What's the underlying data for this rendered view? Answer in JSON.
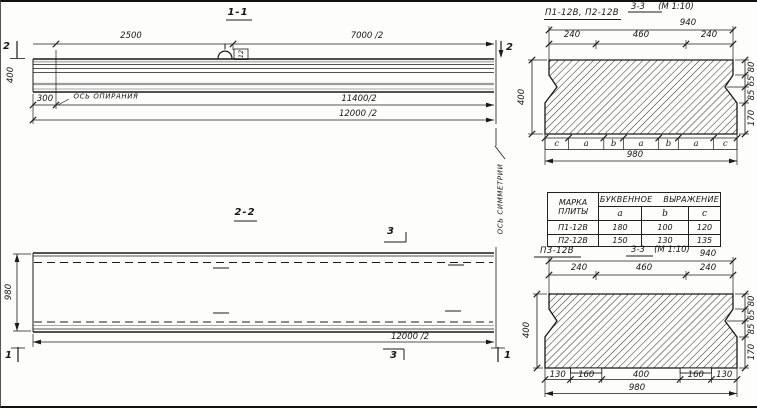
{
  "colors": {
    "ink": "#1a1a1a",
    "shade": "#a8a8a8",
    "paper": "#fdfdfb"
  },
  "section_1_1": {
    "title": "1-1",
    "dim_2500": "2500",
    "dim_7000": "7000 /2",
    "dim_11400": "11400/2",
    "dim_12000": "12000 /2",
    "dim_300": "300",
    "dim_height": "400",
    "support_axis_label": "ОСЬ ОПИРАНИЯ",
    "loop_mark": "12",
    "cut_marker_left": "2",
    "cut_marker_right": "2"
  },
  "section_2_2": {
    "title": "2-2",
    "dim_width": "980",
    "dim_12000": "12000 /2",
    "cut_marker_1_left": "1",
    "cut_marker_1_right": "1",
    "cut_marker_3_top": "3",
    "cut_marker_3_bottom": "3"
  },
  "symmetry_axis_label": "ОСЬ СИММЕТРИИ",
  "section_top": {
    "plate_label": "П1-12В, П2-12В",
    "title": "3-3",
    "scale": "(М 1:10)",
    "dim_total_top": "940",
    "dims_top": [
      "240",
      "460",
      "240"
    ],
    "dim_left": "400",
    "dims_right": [
      "80",
      "65",
      "85",
      "170"
    ],
    "letter_dims": [
      "c",
      "a",
      "b",
      "a",
      "b",
      "a",
      "c"
    ],
    "dim_total_bottom": "980"
  },
  "table": {
    "header_col1": [
      "МАРКА",
      "ПЛИТЫ"
    ],
    "header_span": "БУКВЕННОЕ ВЫРАЖЕНИЕ",
    "letter_columns": [
      "a",
      "b",
      "c"
    ],
    "rows": [
      {
        "mark": "П1-12В",
        "a": "180",
        "b": "100",
        "c": "120"
      },
      {
        "mark": "П2-12В",
        "a": "150",
        "b": "130",
        "c": "135"
      }
    ]
  },
  "section_bottom": {
    "plate_label": "П3-12В",
    "title": "3-3",
    "scale": "(М 1:10)",
    "dim_total_top": "940",
    "dims_top": [
      "240",
      "460",
      "240"
    ],
    "dim_left": "400",
    "dims_right": [
      "80",
      "65",
      "85",
      "170"
    ],
    "dims_bottom": [
      "130",
      "160",
      "400",
      "160",
      "130"
    ],
    "dim_total_bottom": "980"
  }
}
